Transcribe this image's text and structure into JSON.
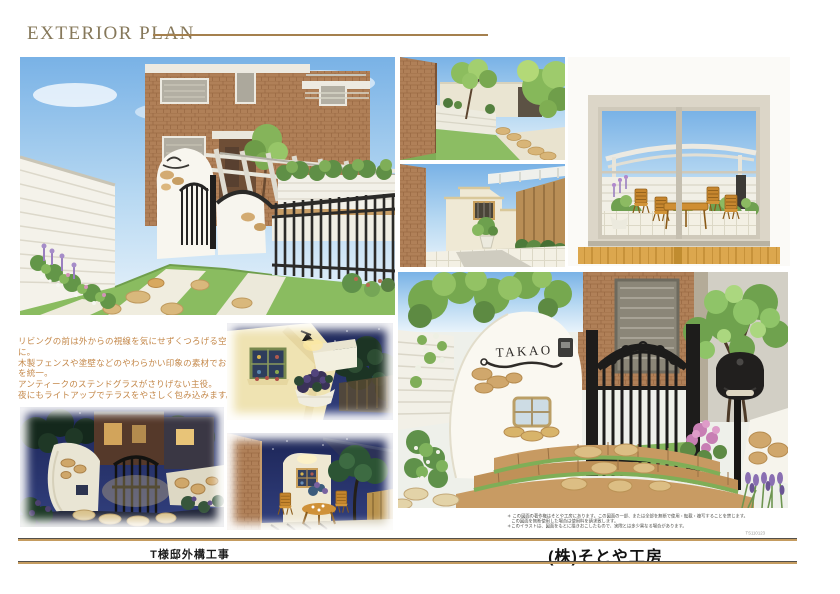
{
  "header": {
    "title": "EXTERIOR PLAN"
  },
  "description": {
    "lines": [
      "リビングの前は外からの視線を気にせずくつろげる空間に。",
      "木製フェンスや塗壁などのやわらかい印象の素材でお庭を統一。",
      "アンティークのステンドグラスがさりげない主役。",
      "夜にもライトアップでテラスをやさしく包み込みます。"
    ]
  },
  "renderings": {
    "nameplate_text": "TAKAO"
  },
  "legal": {
    "lines": [
      "＊ この図面の著作権はそとや工房にあります。この図面の一部、または全部を無断で使用・転載・複写することを禁じます。",
      "　この図面を無断使用した場合は使用料を請求致します。",
      "＊このイラストは、図面をもとに描きおこしたもので、実際とは多少異なる場合があります。"
    ],
    "code": "TS110123"
  },
  "footer": {
    "project": "T様邸外構工事",
    "company": "(株)そとや工房"
  },
  "colors": {
    "accent_line": "#a5804e",
    "title_text": "#86785a",
    "description_text": "#c4884a",
    "sky": "#79b2e6",
    "night_sky": "#232c63",
    "brick": "#b08058",
    "lawn": "#8abc60"
  }
}
